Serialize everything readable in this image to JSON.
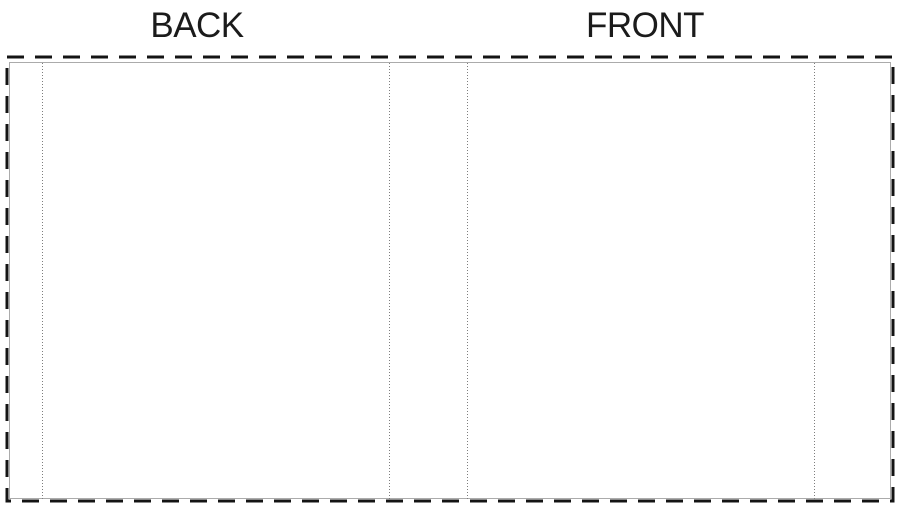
{
  "labels": {
    "back_panel": "BACK",
    "front_panel": "FRONT"
  },
  "colors": {
    "background": "#ffffff",
    "label_text": "#1b1b1b",
    "bleed_border": "#141414",
    "trim_line": "#ababab",
    "fold_line": "#7d7d7d"
  }
}
